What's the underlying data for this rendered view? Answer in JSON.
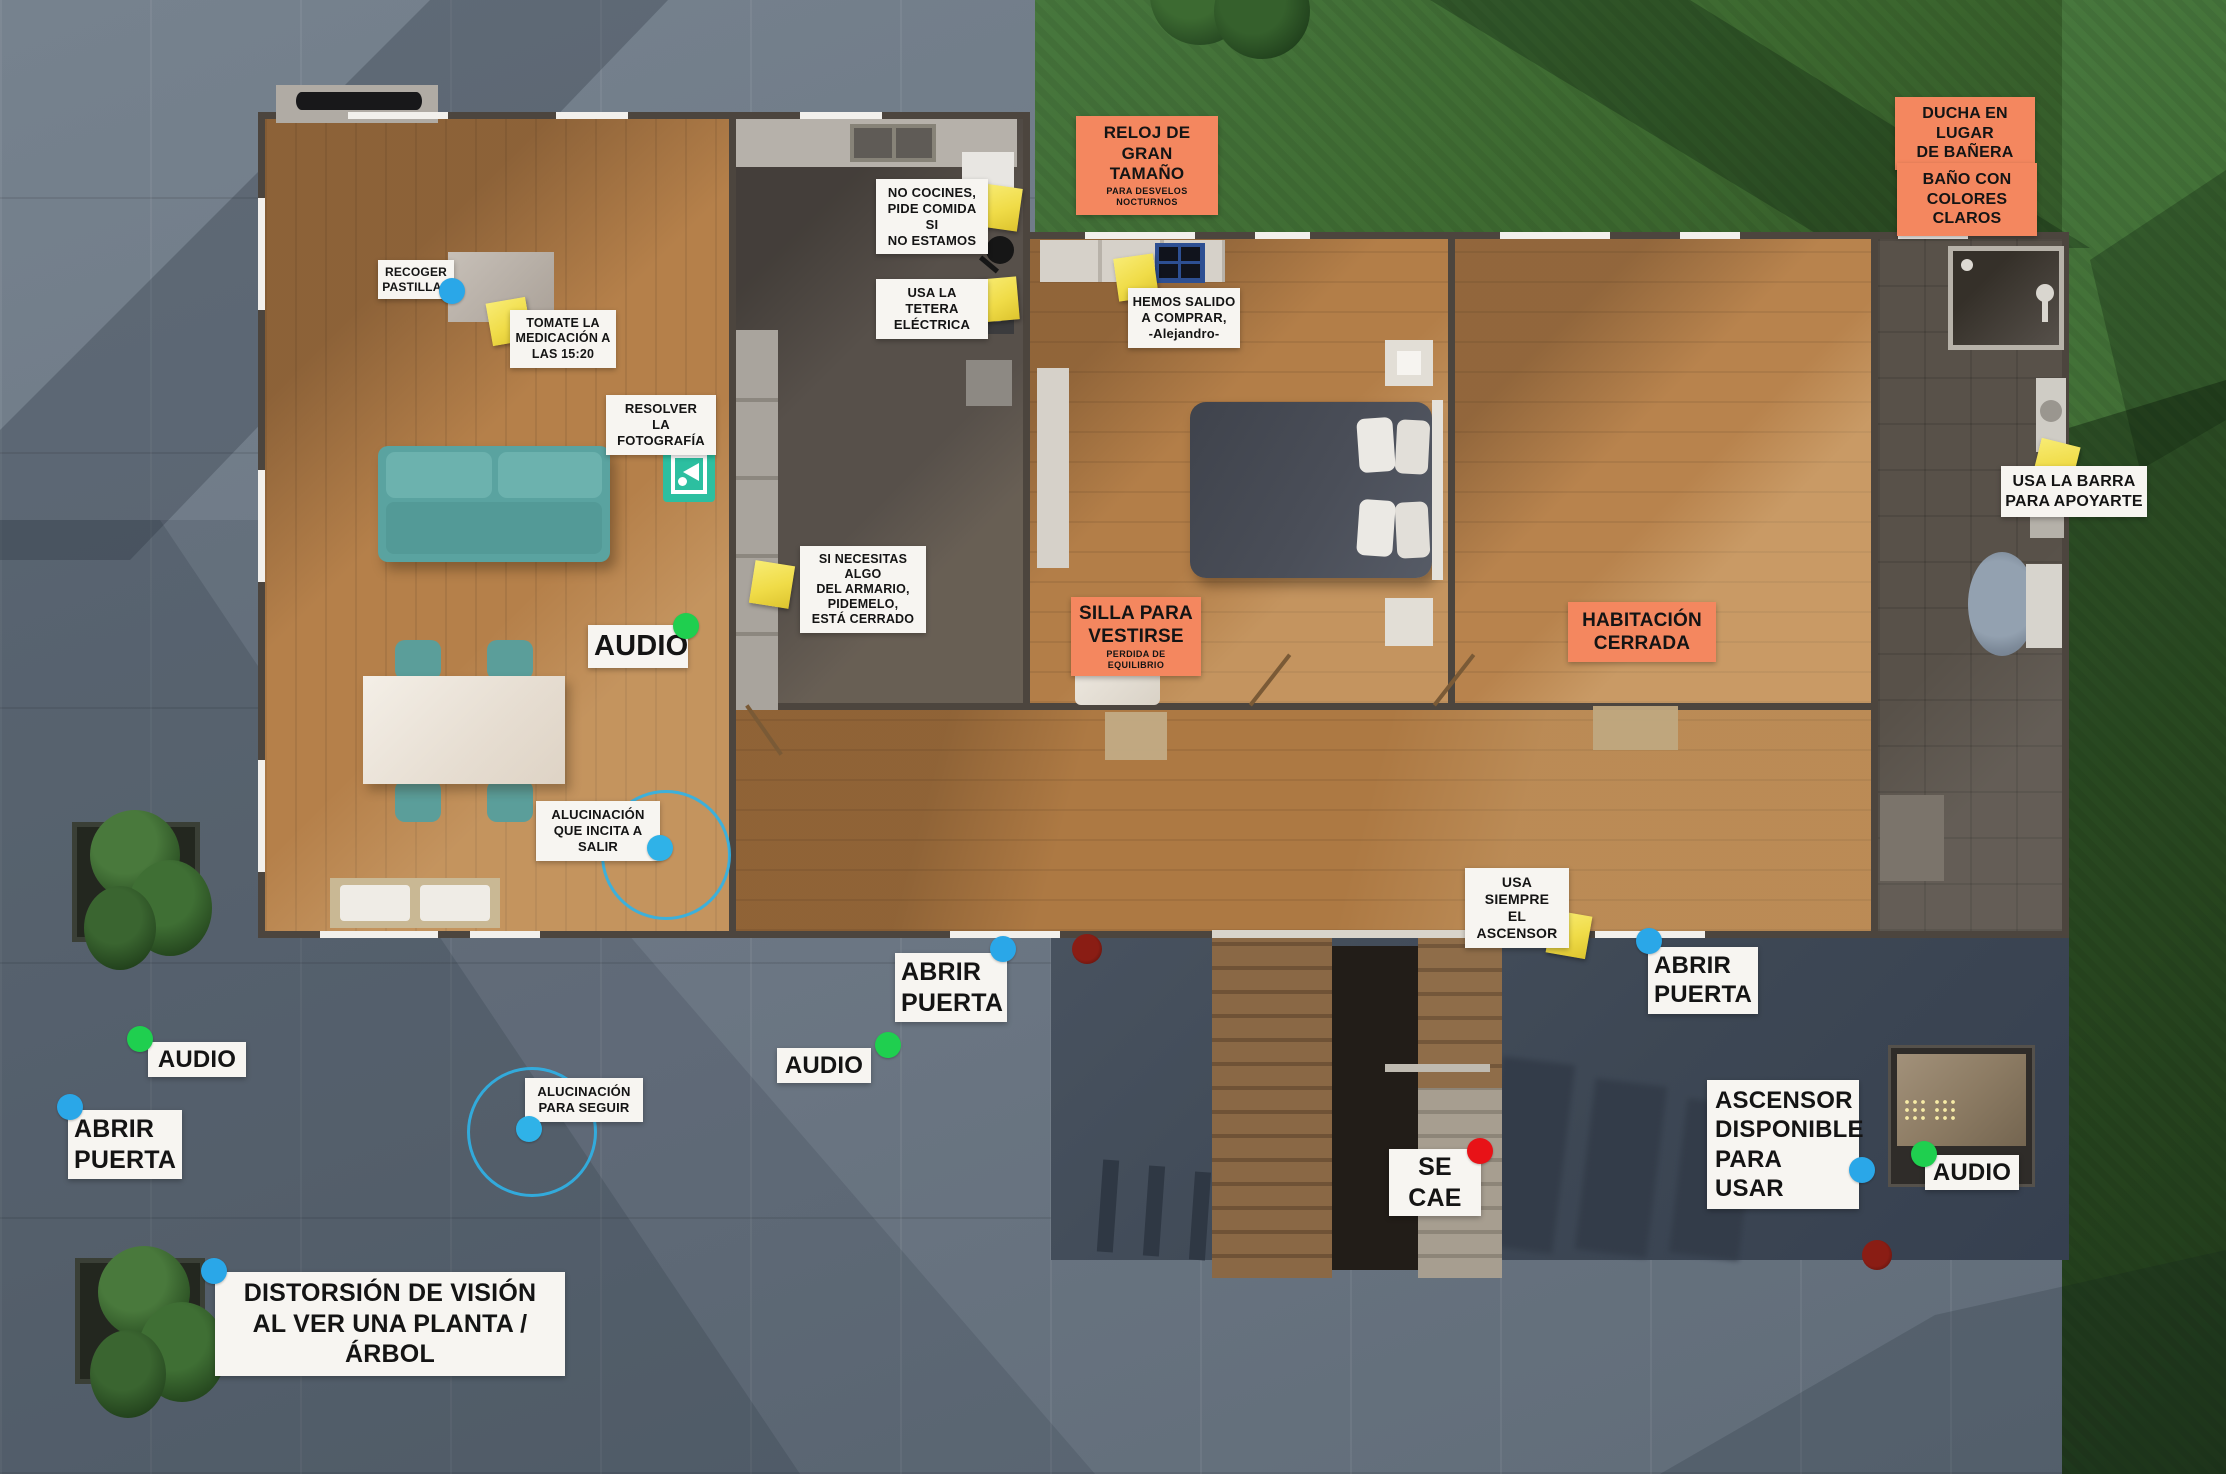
{
  "scene": {
    "description": "top-down floor plan of apartment with outdoor pavement and lawn",
    "colors": {
      "pavement": "#6e7a86",
      "grass": "#3e6a36",
      "wood_floor": "#b5804a",
      "kitchen_floor": "#57504a",
      "bathroom_floor": "#575049",
      "wall": "#4c453e",
      "entry_patio": "#3f4856",
      "label_white": "#f7f5f1",
      "label_orange": "#f4875f",
      "sticky_note_yellow": "#f0dc48",
      "door_dot_blue": "#2aa7e8",
      "audio_dot_green": "#1fcf4f",
      "fall_dot_red": "#e81217",
      "hallucination_cyan": "#2fb2e8",
      "sofa_teal": "#5aa3a0",
      "photo_icon_teal": "#2cbfa0"
    },
    "markers_legend": {
      "blue-dot": "door / interaction point",
      "green-dot": "audio point",
      "red-dot": "fall event point",
      "cyan-dot-with-circle": "hallucination zone",
      "yellow-sticky": "note attached in scene",
      "teal-photo-icon": "photo task marker"
    }
  },
  "labels": {
    "reloj": {
      "variant": "orange",
      "lines": [
        "RELOJ DE GRAN",
        "TAMAÑO"
      ],
      "sub": "PARA DESVELOS NOCTURNOS"
    },
    "ducha": {
      "variant": "orange",
      "lines": [
        "DUCHA EN LUGAR",
        "DE BAÑERA"
      ]
    },
    "bano": {
      "variant": "orange",
      "lines": [
        "BAÑO CON",
        "COLORES CLAROS"
      ]
    },
    "no_cocines": {
      "variant": "white",
      "lines": [
        "NO COCINES,",
        "PIDE COMIDA SI",
        "NO ESTAMOS"
      ]
    },
    "tetera": {
      "variant": "white",
      "lines": [
        "USA LA TETERA",
        "ELÉCTRICA"
      ]
    },
    "hemos_salido": {
      "variant": "white",
      "lines": [
        "HEMOS SALIDO",
        "A COMPRAR,",
        "-Alejandro-"
      ]
    },
    "recoger": {
      "variant": "white",
      "lines": [
        "RECOGER",
        "PASTILLAS"
      ]
    },
    "tomate": {
      "variant": "white",
      "lines": [
        "TOMATE LA",
        "MEDICACIÓN A",
        "LAS 15:20"
      ]
    },
    "resolver": {
      "variant": "white",
      "lines": [
        "RESOLVER",
        "LA FOTOGRAFÍA"
      ]
    },
    "armario": {
      "variant": "white",
      "lines": [
        "SI NECESITAS ALGO",
        "DEL ARMARIO,",
        "PIDEMELO,",
        "ESTÁ CERRADO"
      ]
    },
    "audio_living": {
      "variant": "white",
      "lines": [
        "AUDIO"
      ]
    },
    "silla": {
      "variant": "orange",
      "lines": [
        "SILLA PARA",
        "VESTIRSE"
      ],
      "sub": "PERDIDA DE EQUILIBRIO"
    },
    "habitacion": {
      "variant": "orange",
      "lines": [
        "HABITACIÓN",
        "CERRADA"
      ]
    },
    "barra": {
      "variant": "white",
      "lines": [
        "USA LA BARRA",
        "PARA APOYARTE"
      ]
    },
    "aluc_salir": {
      "variant": "white",
      "lines": [
        "ALUCINACIÓN",
        "QUE INCITA A SALIR"
      ]
    },
    "usa_ascensor": {
      "variant": "white",
      "lines": [
        "USA SIEMPRE",
        "EL ASCENSOR"
      ]
    },
    "abrir_centro": {
      "variant": "white",
      "lines": [
        "ABRIR",
        "PUERTA"
      ]
    },
    "abrir_der": {
      "variant": "white",
      "lines": [
        "ABRIR",
        "PUERTA"
      ]
    },
    "audio_izq": {
      "variant": "white",
      "lines": [
        "AUDIO"
      ]
    },
    "abrir_izq": {
      "variant": "white",
      "lines": [
        "ABRIR",
        "PUERTA"
      ]
    },
    "aluc_seguir": {
      "variant": "white",
      "lines": [
        "ALUCINACIÓN",
        "PARA SEGUIR"
      ]
    },
    "audio_centro": {
      "variant": "white",
      "lines": [
        "AUDIO"
      ]
    },
    "se_cae": {
      "variant": "white",
      "lines": [
        "SE CAE"
      ]
    },
    "ascensor_disp": {
      "variant": "white",
      "lines": [
        "ASCENSOR",
        "DISPONIBLE",
        "PARA USAR"
      ]
    },
    "audio_der": {
      "variant": "white",
      "lines": [
        "AUDIO"
      ]
    },
    "distorsion": {
      "variant": "white",
      "lines": [
        "DISTORSIÓN DE VISIÓN",
        "AL VER UNA PLANTA / ÁRBOL"
      ]
    }
  }
}
